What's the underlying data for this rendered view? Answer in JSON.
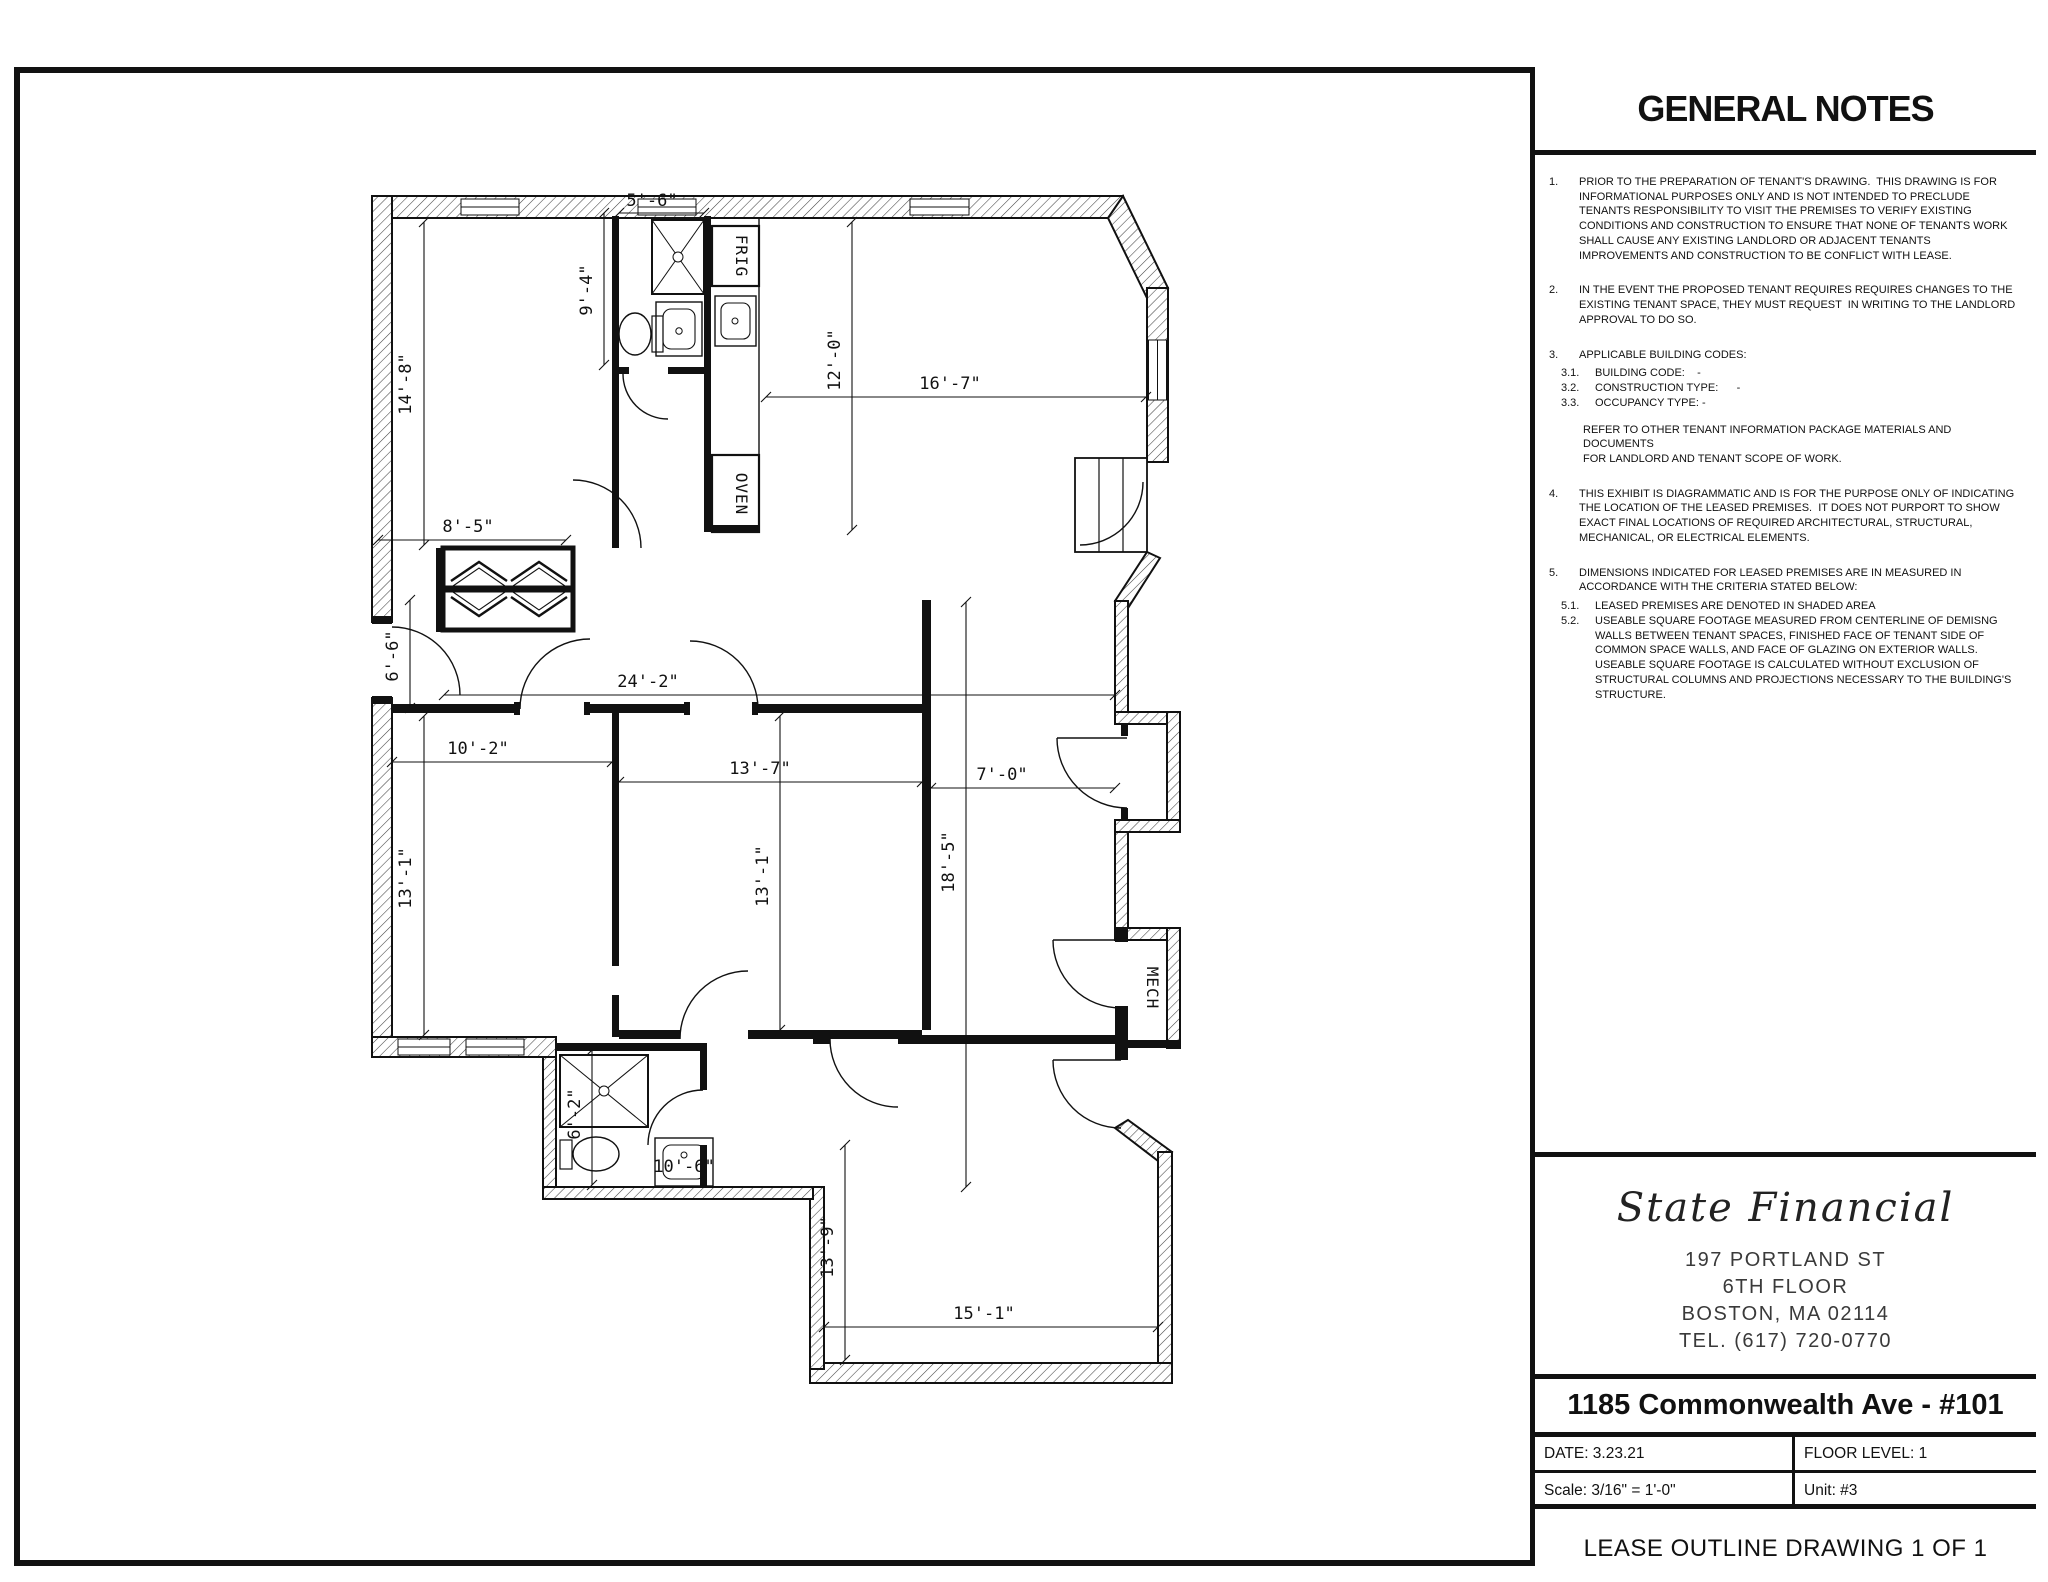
{
  "colors": {
    "ink": "#111111",
    "paper": "#ffffff"
  },
  "general_notes": {
    "title": "GENERAL NOTES",
    "items": [
      {
        "num": "1.",
        "text": "PRIOR TO THE PREPARATION OF TENANT'S DRAWING.  THIS DRAWING IS FOR INFORMATIONAL PURPOSES ONLY AND IS NOT INTENDED TO PRECLUDE TENANTS RESPONSIBILITY TO VISIT THE PREMISES TO VERIFY EXISTING CONDITIONS AND CONSTRUCTION TO ENSURE THAT NONE OF TENANTS WORK SHALL CAUSE ANY EXISTING LANDLORD OR ADJACENT TENANTS IMPROVEMENTS AND CONSTRUCTION TO BE CONFLICT WITH LEASE."
      },
      {
        "num": "2.",
        "text": "IN THE EVENT THE PROPOSED TENANT REQUIRES REQUIRES CHANGES TO THE EXISTING TENANT SPACE, THEY MUST REQUEST  IN WRITING TO THE LANDLORD APPROVAL TO DO SO."
      },
      {
        "num": "3.",
        "text": "APPLICABLE BUILDING CODES:",
        "subs": [
          {
            "num": "3.1.",
            "text": "BUILDING CODE:    -"
          },
          {
            "num": "3.2.",
            "text": "CONSTRUCTION TYPE:      -"
          },
          {
            "num": "3.3.",
            "text": "OCCUPANCY TYPE: -"
          }
        ],
        "extra": "REFER TO OTHER TENANT INFORMATION PACKAGE MATERIALS AND DOCUMENTS\nFOR LANDLORD AND TENANT SCOPE OF WORK."
      },
      {
        "num": "4.",
        "text": "THIS EXHIBIT IS DIAGRAMMATIC AND IS FOR THE PURPOSE ONLY OF INDICATING THE LOCATION OF THE LEASED PREMISES.  IT DOES NOT PURPORT TO SHOW EXACT FINAL LOCATIONS OF REQUIRED ARCHITECTURAL, STRUCTURAL, MECHANICAL, OR ELECTRICAL ELEMENTS."
      },
      {
        "num": "5.",
        "text": "DIMENSIONS INDICATED FOR LEASED PREMISES ARE IN MEASURED IN ACCORDANCE WITH THE CRITERIA STATED BELOW:",
        "subs": [
          {
            "num": "5.1.",
            "text": "LEASED PREMISES ARE DENOTED IN SHADED AREA"
          },
          {
            "num": "5.2.",
            "text": "USEABLE SQUARE FOOTAGE MEASURED FROM CENTERLINE OF DEMISNG WALLS BETWEEN TENANT SPACES, FINISHED FACE OF TENANT SIDE OF COMMON SPACE WALLS, AND FACE OF GLAZING ON EXTERIOR WALLS.  USEABLE SQUARE FOOTAGE IS CALCULATED WITHOUT EXCLUSION OF STRUCTURAL COLUMNS AND PROJECTIONS NECESSARY TO THE BUILDING'S STRUCTURE."
          }
        ]
      }
    ]
  },
  "title_block": {
    "company": "State Financial",
    "address_line1": "197 PORTLAND ST",
    "address_line2": "6TH FLOOR",
    "address_line3": "BOSTON, MA 02114",
    "address_line4": "TEL. (617) 720-0770",
    "project": "1185 Commonwealth Ave - #101",
    "date": "DATE: 3.23.21",
    "floor_level": "FLOOR LEVEL: 1",
    "scale": "Scale:  3/16\" = 1'-0\"",
    "unit": "Unit: #3",
    "drawing_title": "LEASE OUTLINE DRAWING 1 OF 1"
  },
  "plan": {
    "labels": {
      "frig": "FRIG",
      "oven": "OVEN",
      "mech": "MECH"
    },
    "dimensions": {
      "bedroom1_depth": "14'-8\"",
      "bath1_width": "5'-6\"",
      "bath1_depth": "9'-4\"",
      "kitchen_depth": "12'-0\"",
      "living_width": "16'-7\"",
      "closet_width": "8'-5\"",
      "hall_door": "6'-6\"",
      "hallway_length": "24'-2\"",
      "bedroom2_width": "10'-2\"",
      "bedroom3_width": "13'-7\"",
      "entry_width": "7'-0\"",
      "corridor_depth": "18'-5\"",
      "bedroom2_depth": "13'-1\"",
      "bedroom3_depth": "13'-1\"",
      "bath2_depth": "6'-2\"",
      "bath2_width": "10'-6\"",
      "bedroom4_depth": "13'-9\"",
      "bedroom4_width": "15'-1\""
    }
  }
}
